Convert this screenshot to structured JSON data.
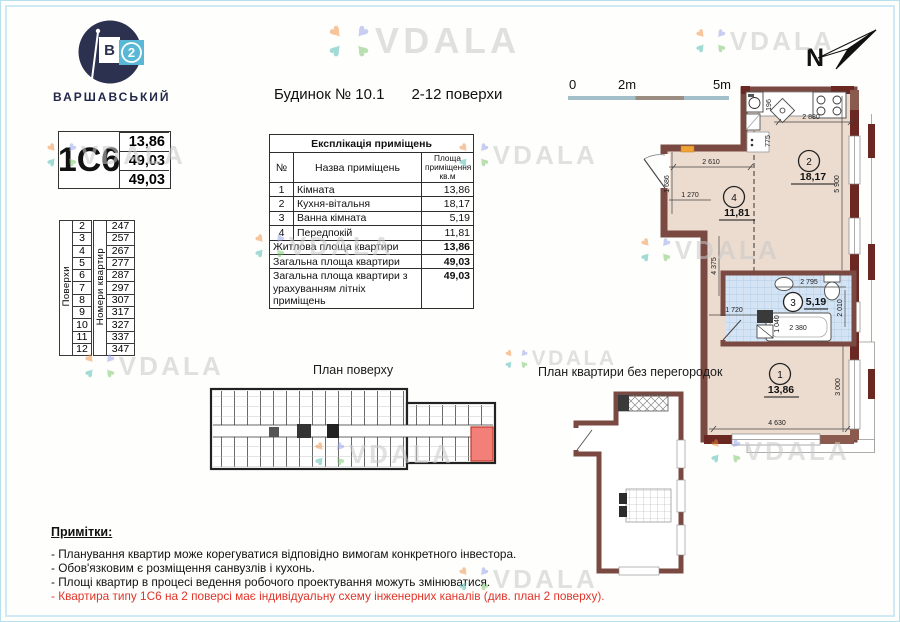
{
  "watermark": {
    "text": "VDALA",
    "heart": "♥"
  },
  "logo": {
    "brand": "ВАРШАВСЬКИЙ",
    "flag_letter": "В",
    "flag_number": "2"
  },
  "header": {
    "building": "Будинок № 10.1",
    "floors": "2-12 поверхи"
  },
  "unit_card": {
    "code": "1С6",
    "values": [
      "13,86",
      "49,03",
      "49,03"
    ]
  },
  "floors_table": {
    "floors_label": "Поверхи",
    "apts_label": "Номери квартир",
    "floors": [
      "2",
      "3",
      "4",
      "5",
      "6",
      "7",
      "8",
      "9",
      "10",
      "11",
      "12"
    ],
    "apartments": [
      "247",
      "257",
      "267",
      "277",
      "287",
      "297",
      "307",
      "317",
      "327",
      "337",
      "347"
    ]
  },
  "explication": {
    "title": "Експлікація приміщень",
    "col_no": "№",
    "col_name": "Назва приміщень",
    "col_area": "Площа приміщення кв.м",
    "rows": [
      {
        "no": "1",
        "name": "Кімната",
        "area": "13,86"
      },
      {
        "no": "2",
        "name": "Кухня-вітальня",
        "area": "18,17"
      },
      {
        "no": "3",
        "name": "Ванна кімната",
        "area": "5,19"
      },
      {
        "no": "4",
        "name": "Передпокій",
        "area": "11,81"
      }
    ],
    "totals": [
      {
        "name": "Житлова площа квартири",
        "area": "13,86"
      },
      {
        "name": "Загальна площа квартири",
        "area": "49,03"
      },
      {
        "name": "Загальна площа квартири з урахуванням літніх приміщень",
        "area": "49,03"
      }
    ]
  },
  "scale_bar": {
    "t0": "0",
    "t1": "2m",
    "t2": "5m"
  },
  "compass": {
    "label": "N"
  },
  "plan": {
    "rooms": {
      "r1": {
        "num": "1",
        "area": "13,86"
      },
      "r2": {
        "num": "2",
        "area": "18,17"
      },
      "r3": {
        "num": "3",
        "area": "5,19"
      },
      "r4": {
        "num": "4",
        "area": "11,81"
      }
    },
    "dims": {
      "d2880": "2 880",
      "d196": "196",
      "d775": "775",
      "d2610": "2 610",
      "d1686": "1 686",
      "d1270": "1 270",
      "d5900": "5 900",
      "d4375": "4 375",
      "d1720": "1 720",
      "d2795": "2 795",
      "d2010": "2 010",
      "d1040": "1 040",
      "d2380": "2 380",
      "d3000": "3 000",
      "d4630": "4 630"
    }
  },
  "floor_plan": {
    "title": "План поверху"
  },
  "open_plan": {
    "title": "План квартири без перегородок"
  },
  "notes": {
    "title": "Примітки:",
    "items": [
      "- Планування квартир може корегуватися відповідно вимогам конкретного інвестора.",
      "- Обов'язковим є розміщення санвузлів і кухонь.",
      "- Площі квартир в процесі ведення робочого проектування можуть змінюватися."
    ],
    "warning": "- Квартира типу 1С6 на 2 поверсі має індивідуальну схему інженерних каналів (див. план 2 поверху)."
  },
  "colors": {
    "accent_red": "#e0342a",
    "unit_highlight": "#f28078",
    "wall": "#7a4a42",
    "floor": "#ecdccf",
    "tile": "#d4e4f4",
    "frame": "#cfeaf4",
    "logo_navy": "#2d3150",
    "logo_blue": "#58b8d6"
  }
}
